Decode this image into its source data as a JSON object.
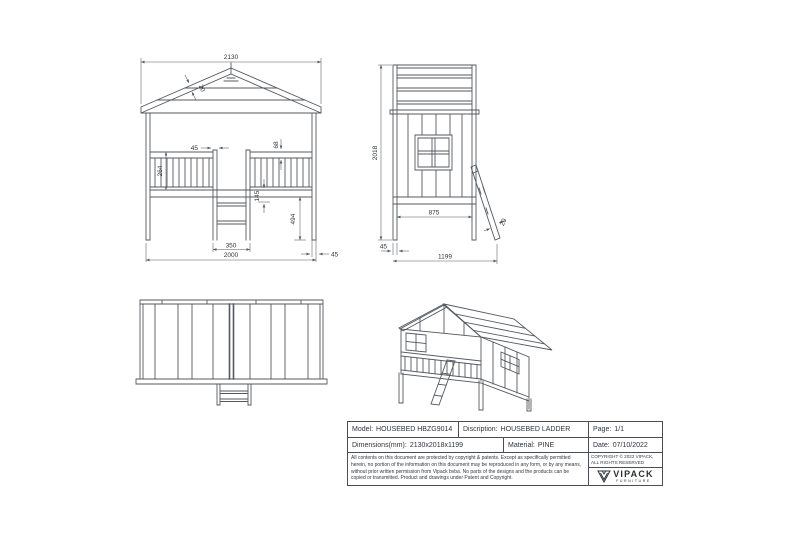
{
  "colors": {
    "line": "#54595e",
    "text": "#303438",
    "background": "#ffffff"
  },
  "views": {
    "front": {
      "dims": {
        "overall_width": "2130",
        "roof_board": "20",
        "ladder_stile_width": "45",
        "rail_board_height": "68",
        "rail_height": "264",
        "bed_frame_height": "145",
        "under_bed_clearance": "494",
        "ladder_width": "350",
        "base_width": "2000",
        "post_width": "45"
      }
    },
    "side": {
      "dims": {
        "overall_height": "2018",
        "inner_depth": "875",
        "post_depth": "45",
        "overall_depth": "1199",
        "ladder_board": "20"
      }
    }
  },
  "title_block": {
    "model": {
      "label": "Model:",
      "value": "HOUSEBED HBZG9014"
    },
    "description": {
      "label": "Discription:",
      "value": "HOUSEBED LADDER"
    },
    "page": {
      "label": "Page:",
      "value": "1/1"
    },
    "dimensions": {
      "label": "Dimensions(mm):",
      "value": "2130x2018x1199"
    },
    "material": {
      "label": "Material:",
      "value": "PINE"
    },
    "date": {
      "label": "Date:",
      "value": "07/10/2022"
    },
    "copyright_notice": "All contents on this document are protected by copyright & patents. Except as specifically permitted herein, no portion of the information on this document may be reproduced in any form, or by any means, without prior written permission from Vipack bvba. No parts of the designs and the products can be copied or transmitted. Product and drawings under Patent and Copyright.",
    "copyright_short": "COPYRIGHT © 2022 VIPACK, ALL RIGHTS RESERVED",
    "brand": {
      "name": "VIPACK",
      "tagline": "FURNITURE"
    }
  }
}
